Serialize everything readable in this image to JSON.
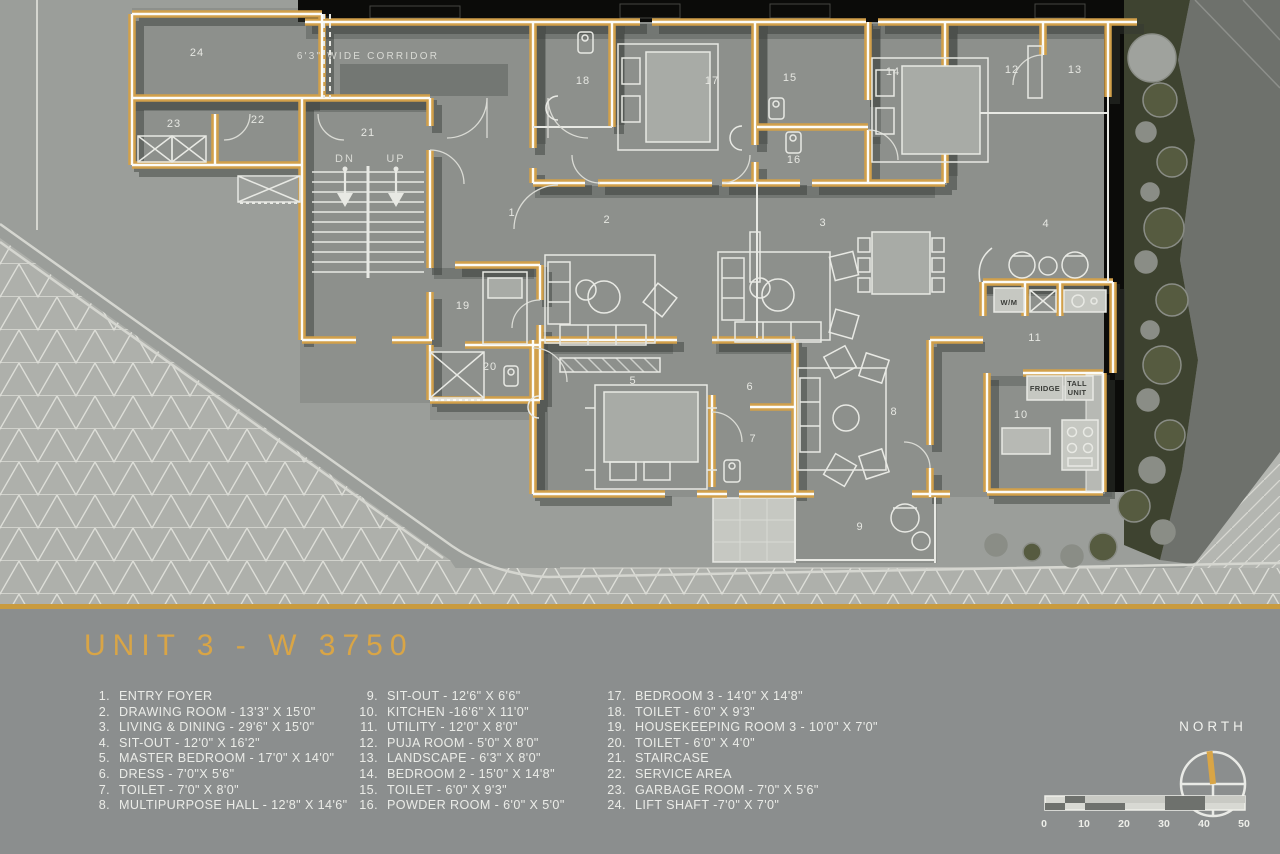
{
  "plan": {
    "corridor_label": "6'3\" WIDE CORRIDOR",
    "room_numbers": [
      {
        "n": "1",
        "x": 512,
        "y": 216
      },
      {
        "n": "2",
        "x": 607,
        "y": 223
      },
      {
        "n": "3",
        "x": 823,
        "y": 226
      },
      {
        "n": "4",
        "x": 1046,
        "y": 227
      },
      {
        "n": "5",
        "x": 633,
        "y": 384
      },
      {
        "n": "6",
        "x": 750,
        "y": 390
      },
      {
        "n": "7",
        "x": 753,
        "y": 442
      },
      {
        "n": "8",
        "x": 894,
        "y": 415
      },
      {
        "n": "9",
        "x": 860,
        "y": 530
      },
      {
        "n": "10",
        "x": 1021,
        "y": 418
      },
      {
        "n": "11",
        "x": 1035,
        "y": 341
      },
      {
        "n": "12",
        "x": 1012,
        "y": 73
      },
      {
        "n": "13",
        "x": 1075,
        "y": 73
      },
      {
        "n": "14",
        "x": 893,
        "y": 75
      },
      {
        "n": "15",
        "x": 790,
        "y": 81
      },
      {
        "n": "16",
        "x": 794,
        "y": 163
      },
      {
        "n": "17",
        "x": 712,
        "y": 84
      },
      {
        "n": "18",
        "x": 583,
        "y": 84
      },
      {
        "n": "19",
        "x": 463,
        "y": 309
      },
      {
        "n": "20",
        "x": 490,
        "y": 370
      },
      {
        "n": "21",
        "x": 368,
        "y": 136
      },
      {
        "n": "22",
        "x": 258,
        "y": 123
      },
      {
        "n": "23",
        "x": 174,
        "y": 127
      },
      {
        "n": "24",
        "x": 197,
        "y": 56
      }
    ],
    "labels": [
      {
        "text": "6'3\" WIDE CORRIDOR",
        "x": 368,
        "y": 59,
        "size": 10,
        "ls": 2.2,
        "style": "light"
      },
      {
        "text": "DN",
        "x": 345,
        "y": 162,
        "size": 11,
        "ls": 2,
        "style": "light"
      },
      {
        "text": "UP",
        "x": 396,
        "y": 162,
        "size": 11,
        "ls": 2,
        "style": "light"
      },
      {
        "text": "W/M",
        "x": 1009,
        "y": 305,
        "size": 7.5,
        "ls": 0.5,
        "style": "dark"
      },
      {
        "text": "FRIDGE",
        "x": 1045,
        "y": 391,
        "size": 7.5,
        "ls": 0.3,
        "style": "dark"
      },
      {
        "text": "TALL",
        "x": 1077,
        "y": 386,
        "size": 7.5,
        "ls": 0.3,
        "style": "dark"
      },
      {
        "text": "UNIT",
        "x": 1077,
        "y": 395,
        "size": 7.5,
        "ls": 0.3,
        "style": "dark"
      }
    ]
  },
  "panel": {
    "title": "UNIT 3 - W 3750",
    "legend_columns": [
      [
        {
          "n": "1.",
          "label": "ENTRY FOYER"
        },
        {
          "n": "2.",
          "label": "DRAWING ROOM - 13'3\" X 15'0\""
        },
        {
          "n": "3.",
          "label": "LIVING & DINING - 29'6\" X 15'0\""
        },
        {
          "n": "4.",
          "label": "SIT-OUT - 12'0\" X 16'2\""
        },
        {
          "n": "5.",
          "label": "MASTER BEDROOM - 17'0\" X 14'0\""
        },
        {
          "n": "6.",
          "label": "DRESS - 7'0\"X 5'6\""
        },
        {
          "n": "7.",
          "label": "TOILET - 7'0\" X 8'0\""
        },
        {
          "n": "8.",
          "label": "MULTIPURPOSE HALL - 12'8\" X 14'6\""
        }
      ],
      [
        {
          "n": "9.",
          "label": "SIT-OUT - 12'6\" X 6'6\""
        },
        {
          "n": "10.",
          "label": "KITCHEN -16'6\" X 11'0\""
        },
        {
          "n": "11.",
          "label": "UTILITY - 12'0\" X 8'0\""
        },
        {
          "n": "12.",
          "label": "PUJA ROOM - 5'0\" X 8'0\""
        },
        {
          "n": "13.",
          "label": "LANDSCAPE - 6'3\" X 8'0\""
        },
        {
          "n": "14.",
          "label": "BEDROOM 2 - 15'0\" X 14'8\""
        },
        {
          "n": "15.",
          "label": "TOILET - 6'0\" X 9'3\""
        },
        {
          "n": "16.",
          "label": "POWDER ROOM - 6'0\" X 5'0\""
        }
      ],
      [
        {
          "n": "17.",
          "label": "BEDROOM 3 - 14'0\" X 14'8\""
        },
        {
          "n": "18.",
          "label": "TOILET - 6'0\" X 9'3\""
        },
        {
          "n": "19.",
          "label": "HOUSEKEEPING ROOM 3 - 10'0\" X 7'0\""
        },
        {
          "n": "20.",
          "label": "TOILET - 6'0\" X 4'0\""
        },
        {
          "n": "21.",
          "label": "STAIRCASE"
        },
        {
          "n": "22.",
          "label": "SERVICE AREA"
        },
        {
          "n": "23.",
          "label": "GARBAGE ROOM - 7'0\" X 5'6\""
        },
        {
          "n": "24.",
          "label": "LIFT SHAFT -7'0\" X 7'0\""
        }
      ]
    ],
    "north_label": "NORTH",
    "scale_ticks": [
      "0",
      "10",
      "20",
      "30",
      "40",
      "50"
    ]
  },
  "colors": {
    "accent_gold": "#D9A546",
    "wall_gold": "#D2A04A",
    "panel_bg": "#8B8E8E",
    "ground": "#9B9E9A",
    "floor": "#8D908C",
    "black_band": "#0B0B09",
    "landscape_olive": "#3E4330",
    "text_light": "#EBECE8"
  }
}
